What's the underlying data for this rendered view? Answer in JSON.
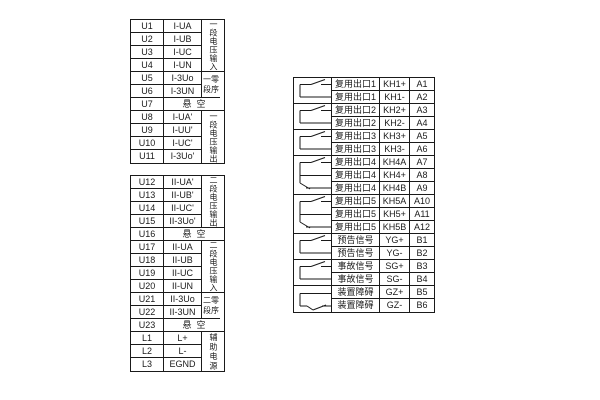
{
  "diagram": {
    "bg": "#ffffff",
    "line_color": "#1a1a1a",
    "symbols": {
      "no": "normally-open-contact",
      "co": "changeover-contact",
      "nc": "normally-closed-contact"
    }
  },
  "left_table_1": {
    "rows": [
      {
        "t": "U1",
        "s": "I-UA"
      },
      {
        "t": "U2",
        "s": "I-UB"
      },
      {
        "t": "U3",
        "s": "I-UC"
      },
      {
        "t": "U4",
        "s": "I-UN"
      },
      {
        "t": "U5",
        "s": "I-3Uo"
      },
      {
        "t": "U6",
        "s": "I-3UN"
      },
      {
        "t": "U7",
        "s": "悬空",
        "merged": true
      },
      {
        "t": "U8",
        "s": "I-UA'"
      },
      {
        "t": "U9",
        "s": "I-UU'"
      },
      {
        "t": "U10",
        "s": "I-UC'"
      },
      {
        "t": "U11",
        "s": "I-3Uo'"
      }
    ],
    "labels": [
      {
        "text": "一段电压输入",
        "mode": "vertical",
        "start": 1,
        "span": 4
      },
      {
        "text": "一零段序",
        "mode": "wrap",
        "start": 5,
        "span": 2
      },
      {
        "text": "一段电压输出",
        "mode": "vertical",
        "start": 8,
        "span": 4
      }
    ]
  },
  "left_table_2": {
    "rows": [
      {
        "t": "U12",
        "s": "II-UA'"
      },
      {
        "t": "U13",
        "s": "II-UB'"
      },
      {
        "t": "U14",
        "s": "II-UC'"
      },
      {
        "t": "U15",
        "s": "II-3Uo'"
      },
      {
        "t": "U16",
        "s": "悬空",
        "merged": true
      },
      {
        "t": "U17",
        "s": "II-UA"
      },
      {
        "t": "U18",
        "s": "II-UB"
      },
      {
        "t": "U19",
        "s": "II-UC"
      },
      {
        "t": "U20",
        "s": "II-UN"
      },
      {
        "t": "U21",
        "s": "II-3Uo"
      },
      {
        "t": "U22",
        "s": "II-3UN"
      },
      {
        "t": "U23",
        "s": "悬空",
        "merged": true
      },
      {
        "t": "L1",
        "s": "L+"
      },
      {
        "t": "L2",
        "s": "L-"
      },
      {
        "t": "L3",
        "s": "EGND"
      }
    ],
    "labels": [
      {
        "text": "二段电压输出",
        "mode": "vertical",
        "start": 1,
        "span": 4
      },
      {
        "text": "二段电压输入",
        "mode": "vertical",
        "start": 6,
        "span": 4
      },
      {
        "text": "二零段序",
        "mode": "wrap",
        "start": 10,
        "span": 2
      },
      {
        "text": "辅助电源",
        "mode": "vertical4",
        "start": 13,
        "span": 3
      }
    ]
  },
  "right_table": {
    "rows": [
      {
        "label": "复用出口1",
        "term": "KH1+",
        "num": "A1"
      },
      {
        "label": "复用出口1",
        "term": "KH1-",
        "num": "A2"
      },
      {
        "label": "复用出口2",
        "term": "KH2+",
        "num": "A3"
      },
      {
        "label": "复用出口2",
        "term": "KH2-",
        "num": "A4"
      },
      {
        "label": "复用出口3",
        "term": "KH3+",
        "num": "A5"
      },
      {
        "label": "复用出口3",
        "term": "KH3-",
        "num": "A6"
      },
      {
        "label": "复用出口4",
        "term": "KH4A",
        "num": "A7"
      },
      {
        "label": "复用出口4",
        "term": "KH4+",
        "num": "A8"
      },
      {
        "label": "复用出口4",
        "term": "KH4B",
        "num": "A9"
      },
      {
        "label": "复用出口5",
        "term": "KH5A",
        "num": "A10"
      },
      {
        "label": "复用出口5",
        "term": "KH5+",
        "num": "A11"
      },
      {
        "label": "复用出口5",
        "term": "KH5B",
        "num": "A12"
      },
      {
        "label": "预告信号",
        "term": "YG+",
        "num": "B1"
      },
      {
        "label": "预告信号",
        "term": "YG-",
        "num": "B2"
      },
      {
        "label": "事故信号",
        "term": "SG+",
        "num": "B3"
      },
      {
        "label": "事故信号",
        "term": "SG-",
        "num": "B4"
      },
      {
        "label": "装置障碍",
        "term": "GZ+",
        "num": "B5"
      },
      {
        "label": "装置障碍",
        "term": "GZ-",
        "num": "B6"
      }
    ],
    "groups": [
      {
        "sym": "no",
        "rows": 2
      },
      {
        "sym": "no",
        "rows": 2
      },
      {
        "sym": "no",
        "rows": 2
      },
      {
        "sym": "co",
        "rows": 3
      },
      {
        "sym": "co",
        "rows": 3
      },
      {
        "sym": "no",
        "rows": 2
      },
      {
        "sym": "no",
        "rows": 2
      },
      {
        "sym": "nc",
        "rows": 2
      }
    ]
  }
}
